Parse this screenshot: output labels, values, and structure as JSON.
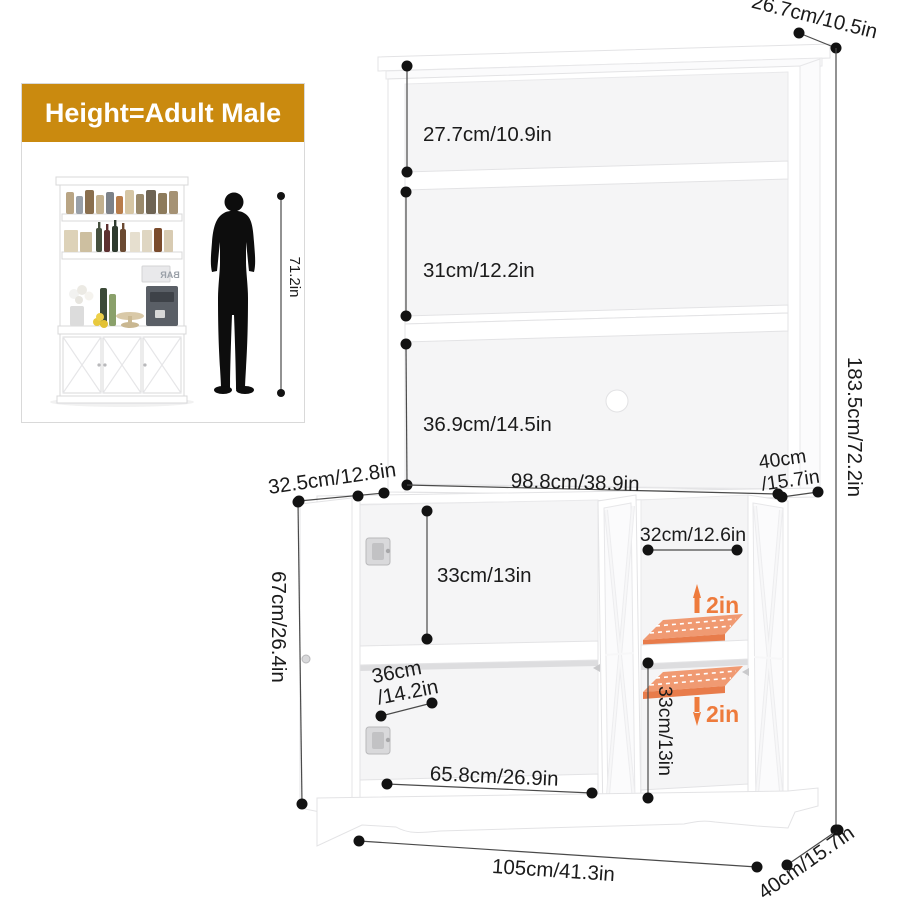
{
  "inset": {
    "header": "Height=Adult Male",
    "height_label": "71.2in",
    "bar_sign": "BAR"
  },
  "cabinet": {
    "top_depth": "26.7cm/10.5in",
    "hutch_shelf_1": "27.7cm/10.9in",
    "hutch_shelf_2": "31cm/12.2in",
    "hutch_shelf_3": "36.9cm/14.5in",
    "total_height": "183.5cm/72.2in",
    "hutch_depth_line1": "40cm",
    "hutch_depth_line2": "/15.7in",
    "hutch_width": "98.8cm/38.9in",
    "left_door_width": "32.5cm/12.8in",
    "base_cabinet_height": "67cm/26.4in",
    "left_cabinet_height": "33cm/13in",
    "left_cabinet_depth_line1": "36cm",
    "left_cabinet_depth_line2": "/14.2in",
    "left_cabinet_width": "65.8cm/26.9in",
    "base_width": "105cm/41.3in",
    "base_depth": "40cm/15.7in",
    "right_cabinet_width": "32cm/12.6in",
    "shelf_up_adjust": "2in",
    "shelf_down_adjust": "2in",
    "right_cabinet_height": "33cm/13in"
  },
  "colors": {
    "header_gold": "#ca8a0f",
    "accent_orange": "#ee7b3c",
    "shelf_orange": "#f09a72",
    "dim_line": "#4a4a4a"
  }
}
